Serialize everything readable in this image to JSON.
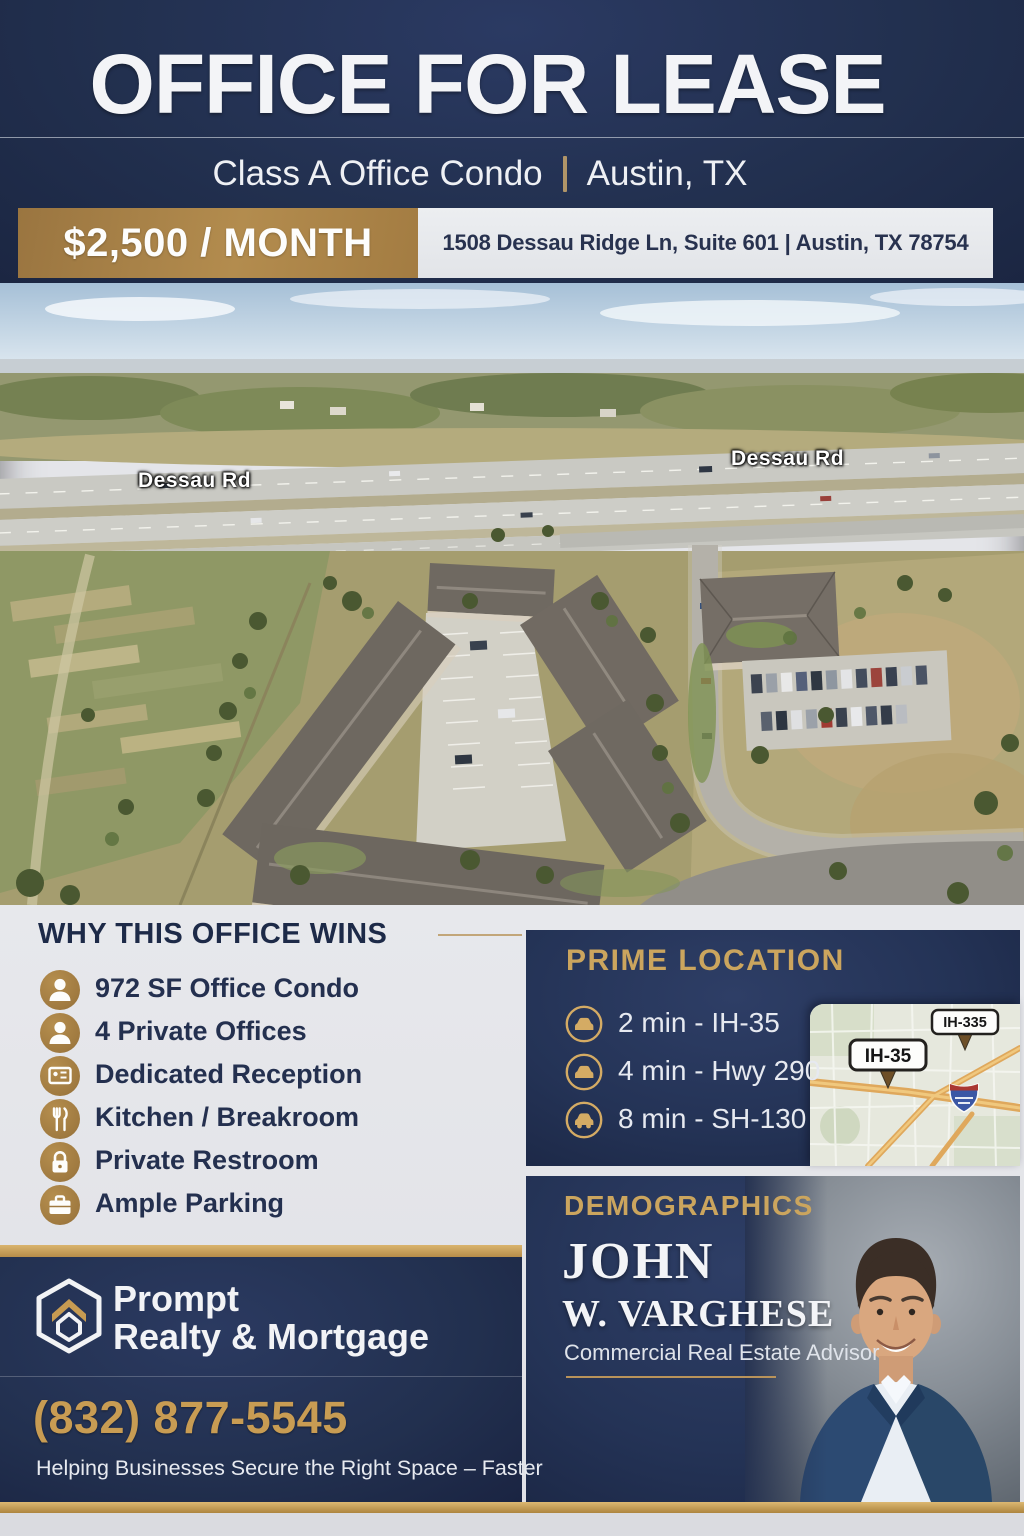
{
  "header": {
    "title": "OFFICE FOR LEASE",
    "subtitle_left": "Class A Office Condo",
    "subtitle_right": "Austin, TX",
    "price": "$2,500 / MONTH",
    "address": "1508 Dessau Ridge Ln, Suite 601 | Austin, TX 78754"
  },
  "photo": {
    "road_label_left": "Dessau Rd",
    "road_label_right": "Dessau Rd"
  },
  "features": {
    "heading": "WHY THIS OFFICE WINS",
    "items": [
      {
        "icon": "person-icon",
        "label": "972 SF Office Condo"
      },
      {
        "icon": "person-icon",
        "label": "4 Private Offices"
      },
      {
        "icon": "reception-icon",
        "label": "Dedicated Reception"
      },
      {
        "icon": "kitchen-icon",
        "label": "Kitchen / Breakroom"
      },
      {
        "icon": "restroom-icon",
        "label": "Private Restroom"
      },
      {
        "icon": "parking-icon",
        "label": "Ample Parking"
      }
    ]
  },
  "location": {
    "heading": "PRIME LOCATION",
    "items": [
      {
        "icon": "car-icon",
        "label": "2 min - IH-35"
      },
      {
        "icon": "car-icon",
        "label": "4 min - Hwy 290"
      },
      {
        "icon": "car-icon",
        "label": "8 min - SH-130"
      }
    ],
    "map": {
      "label_primary": "IH-35",
      "label_secondary": "IH-335"
    }
  },
  "demographics": {
    "heading": "DEMOGRAPHICS",
    "agent_first": "JOHN",
    "agent_last": "W. VARGHESE",
    "agent_title": "Commercial Real Estate Advisor"
  },
  "brand": {
    "name_line1": "Prompt",
    "name_line2": "Realty & Mortgage",
    "phone": "(832) 877-5545",
    "tagline": "Helping Businesses Secure the Right Space – Faster"
  },
  "colors": {
    "navy": "#22304f",
    "gold": "#b38c4e",
    "gold_text": "#cba55e",
    "light": "#e4e5e9"
  }
}
